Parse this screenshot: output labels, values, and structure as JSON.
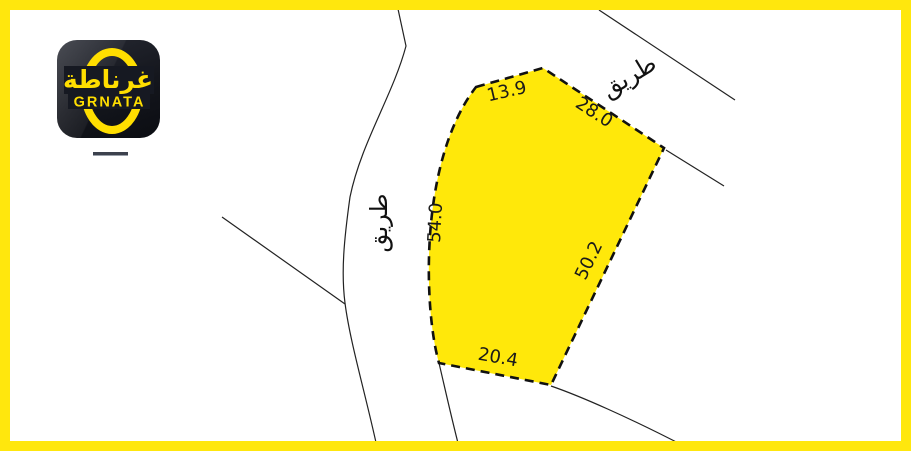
{
  "frame": {
    "color": "#ffe70d"
  },
  "brand": {
    "latin": "GRNATA",
    "arabic": "غرناطة",
    "accent": "#ffde00",
    "tile_bg": "#14161d"
  },
  "map": {
    "plot": {
      "fill": "#ffe80a",
      "outline": "#111111",
      "edges": [
        {
          "side": "top-left",
          "label": "13.9"
        },
        {
          "side": "top-right",
          "label": "28.0"
        },
        {
          "side": "left",
          "label": "54.0"
        },
        {
          "side": "right",
          "label": "50.2"
        },
        {
          "side": "bottom",
          "label": "20.4"
        }
      ]
    },
    "roads": [
      {
        "id": "west-road",
        "label": "طريق"
      },
      {
        "id": "northeast-road",
        "label": "طريق"
      }
    ]
  }
}
